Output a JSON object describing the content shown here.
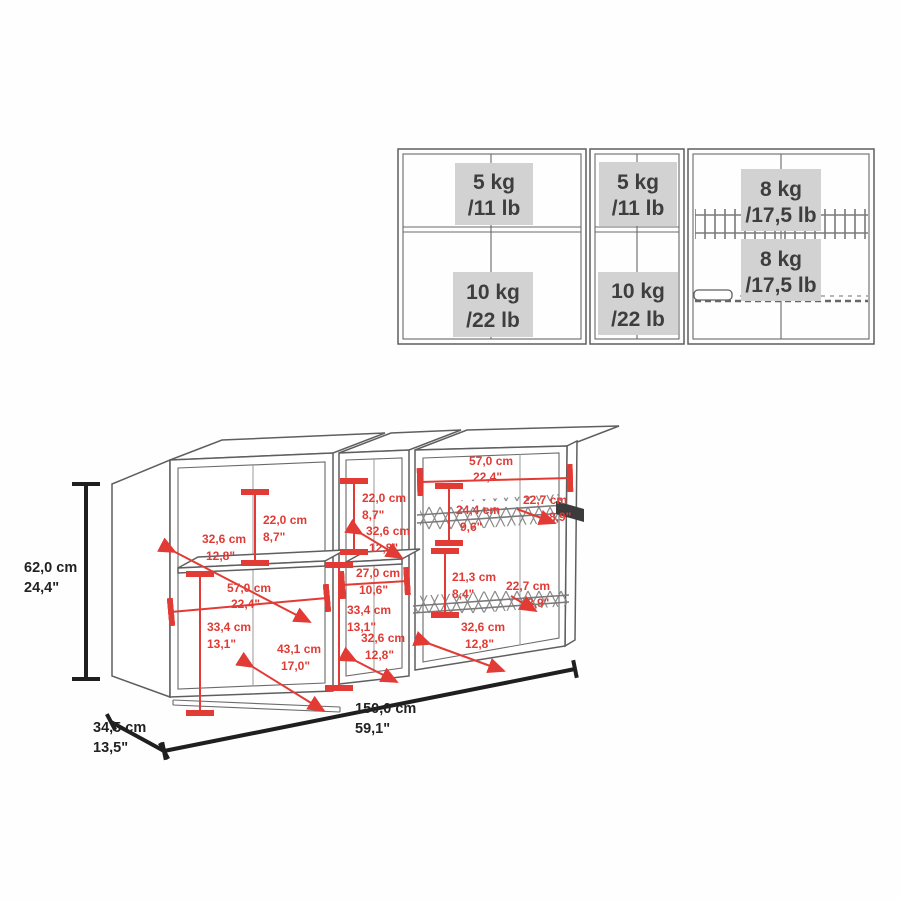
{
  "title": "Wall cabinet load capacity and dimension diagram",
  "colors": {
    "dimension_red": "#e23b35",
    "cabinet_line": "#5f5f5f",
    "label_background": "#d2d2d2",
    "label_text": "#3e3e3e",
    "dimension_black": "#1f1f1f"
  },
  "load_diagram": {
    "sections": [
      {
        "id": "left",
        "top": {
          "kg": "5 kg",
          "lb": "/11 lb"
        },
        "bottom": {
          "kg": "10 kg",
          "lb": "/22 lb"
        }
      },
      {
        "id": "middle",
        "top": {
          "kg": "5 kg",
          "lb": "/11 lb"
        },
        "bottom": {
          "kg": "10 kg",
          "lb": "/22 lb"
        }
      },
      {
        "id": "right",
        "top": {
          "kg": "8 kg",
          "lb": "/17,5 lb"
        },
        "bottom": {
          "kg": "8 kg",
          "lb": "/17,5 lb"
        }
      }
    ]
  },
  "dims": {
    "overall_height": {
      "cm": "62,0 cm",
      "in": "24,4\""
    },
    "overall_depth": {
      "cm": "34,5 cm",
      "in": "13,5\""
    },
    "overall_width": {
      "cm": "150,0 cm",
      "in": "59,1\""
    },
    "a_shelf_depth": {
      "cm": "32,6 cm",
      "in": "12,8\""
    },
    "a_top_height": {
      "cm": "22,0 cm",
      "in": "8,7\""
    },
    "a_width": {
      "cm": "57,0 cm",
      "in": "22,4\""
    },
    "a_bottom_height": {
      "cm": "33,4 cm",
      "in": "13,1\""
    },
    "a_bottom_depth": {
      "cm": "43,1 cm",
      "in": "17,0\""
    },
    "b_top_height": {
      "cm": "22,0 cm",
      "in": "8,7\""
    },
    "b_shelf_depth": {
      "cm": "32,6 cm",
      "in": "12,8\""
    },
    "b_width": {
      "cm": "27,0 cm",
      "in": "10,6\""
    },
    "b_bottom_height": {
      "cm": "33,4 cm",
      "in": "13,1\""
    },
    "b_bottom_depth": {
      "cm": "32,6 cm",
      "in": "12,8\""
    },
    "c_width": {
      "cm": "57,0 cm",
      "in": "22,4\""
    },
    "c_top_rack_drop": {
      "cm": "24,4 cm",
      "in": "9,6\""
    },
    "c_top_rack_depth": {
      "cm": "22,7 cm",
      "in": "8,9\""
    },
    "c_rack_gap": {
      "cm": "21,3 cm",
      "in": "8,4\""
    },
    "c_bottom_rack_depth": {
      "cm": "22,7 cm",
      "in": "8,9\""
    },
    "c_bottom_depth": {
      "cm": "32,6 cm",
      "in": "12,8\""
    }
  }
}
